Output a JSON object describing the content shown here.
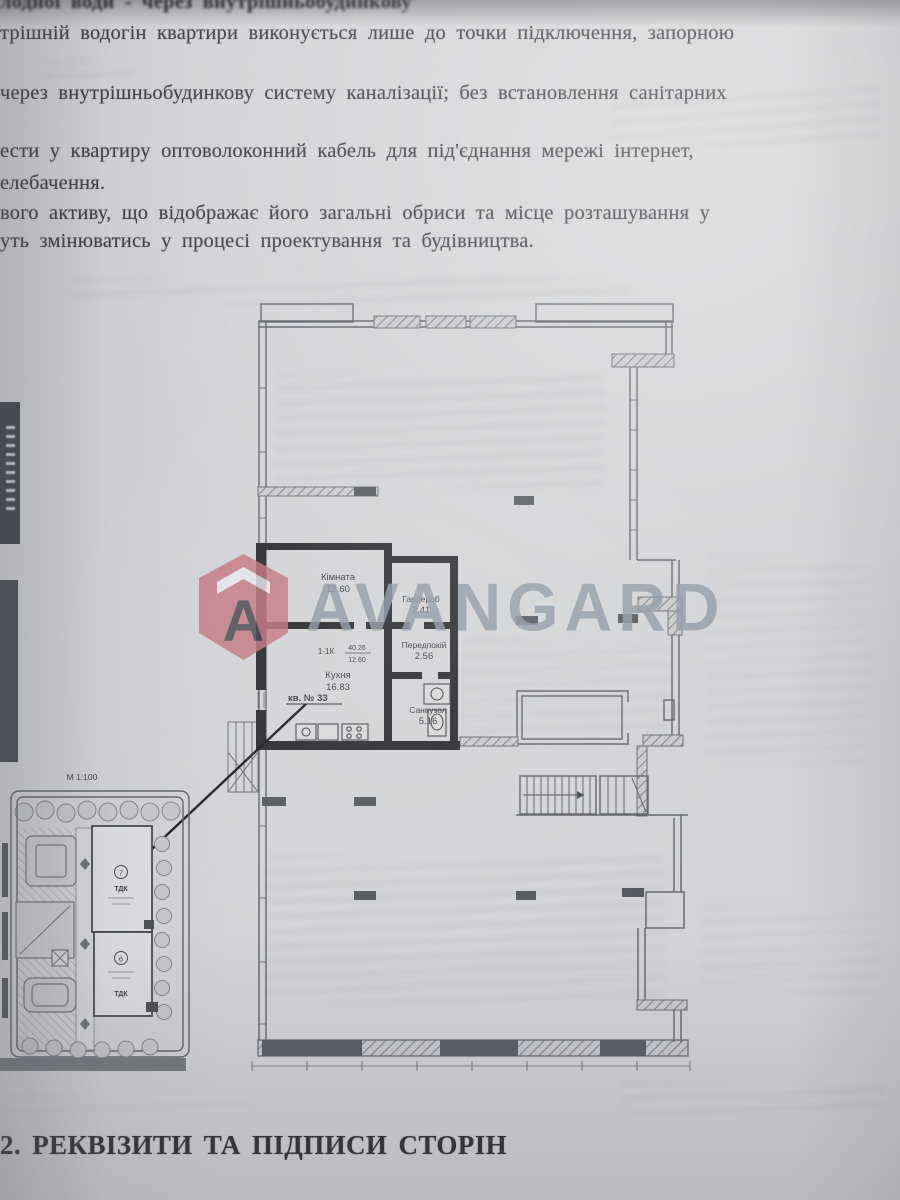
{
  "document_text": {
    "top_cropped_line": "лодної води - через внутрішньобудинкову",
    "lines": [
      "трішній водогін квартири виконується лише до точки підключення, запорною",
      "через внутрішньобудинкову систему каналізації; без встановлення санітарних",
      "ести у квартиру оптоволоконний кабель для під'єднання мережі інтернет,",
      "елебачення.",
      "вого активу, що відображає його загальні обриси та місце розташування у",
      "уть змінюватись у процесі проектування та будівництва."
    ]
  },
  "watermark": {
    "brand": "AVANGARD",
    "icon_letter": "A",
    "icon_color": "#c4767f",
    "text_color": "#8b97a5"
  },
  "floor_plan": {
    "apartment_label": "кв. № 33",
    "unit_code": "1-1К",
    "unit_area_top": "40.26",
    "unit_area_bottom": "12.60",
    "rooms": [
      {
        "name": "Кімната",
        "area": "12.60"
      },
      {
        "name": "Гардероб",
        "area": "2.41"
      },
      {
        "name": "Передпокій",
        "area": "2.56"
      },
      {
        "name": "Кухня",
        "area": "16.83"
      },
      {
        "name": "Санвузол",
        "area": "5.16"
      }
    ]
  },
  "site_plan": {
    "scale_label": "М 1:100",
    "buildings": [
      {
        "number": "7",
        "label": "ТДК"
      },
      {
        "number": "6",
        "label": "ТДК"
      }
    ]
  },
  "footer": {
    "heading": "2. РЕКВІЗИТИ ТА ПІДПИСИ СТОРІН"
  }
}
